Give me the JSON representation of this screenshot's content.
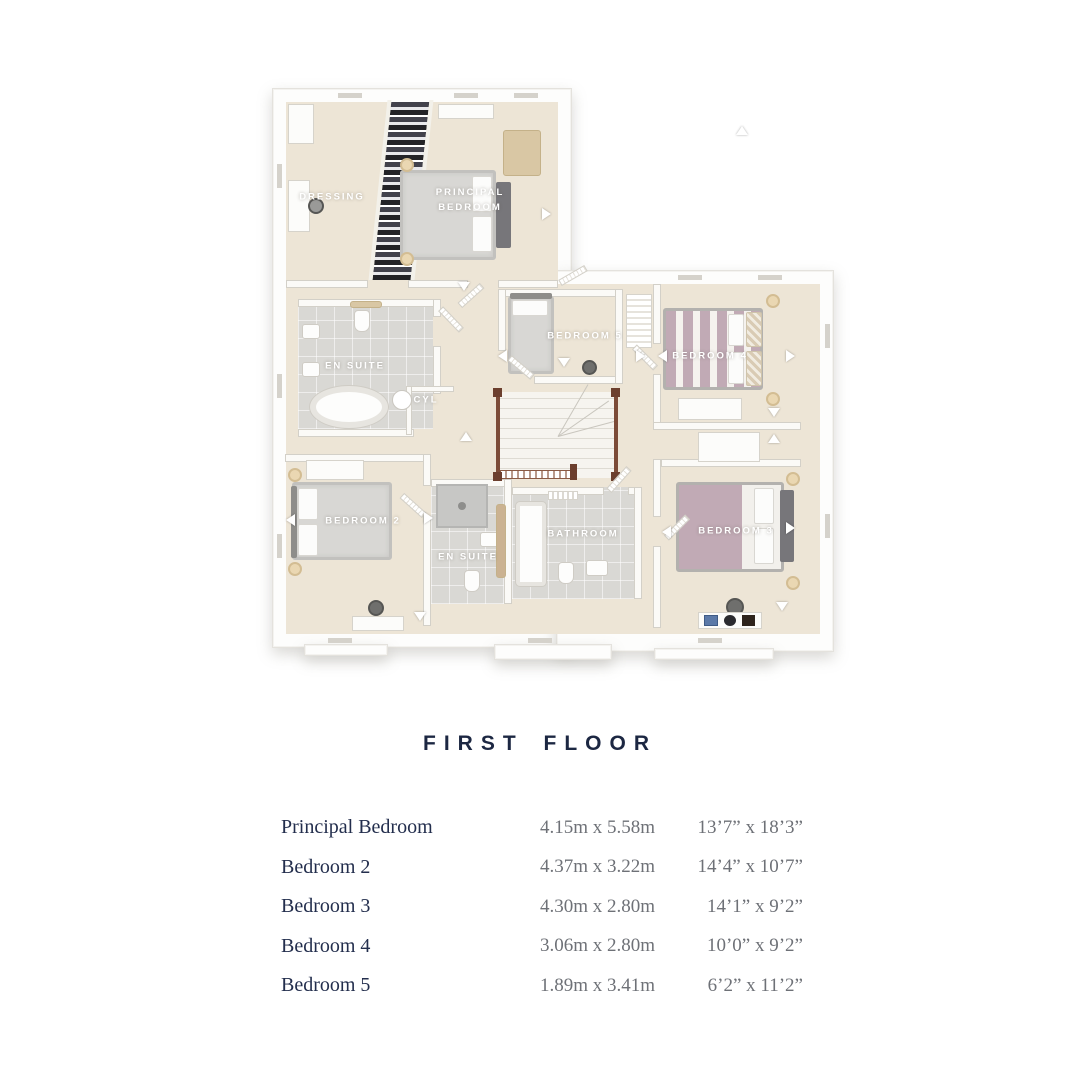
{
  "title": "FIRST FLOOR",
  "plan": {
    "rooms": [
      {
        "id": "dressing",
        "label": "DRESSING"
      },
      {
        "id": "principal-bedroom",
        "label": "PRINCIPAL BEDROOM"
      },
      {
        "id": "en-suite-1",
        "label": "EN SUITE"
      },
      {
        "id": "cyl",
        "label": "CYL"
      },
      {
        "id": "bedroom-5",
        "label": "BEDROOM 5"
      },
      {
        "id": "bedroom-4",
        "label": "BEDROOM 4"
      },
      {
        "id": "bedroom-2",
        "label": "BEDROOM 2"
      },
      {
        "id": "en-suite-2",
        "label": "EN SUITE"
      },
      {
        "id": "bathroom",
        "label": "BATHROOM"
      },
      {
        "id": "bedroom-3",
        "label": "BEDROOM 3"
      }
    ]
  },
  "dimensions_table": {
    "rows": [
      {
        "room": "Principal Bedroom",
        "metric": "4.15m x 5.58m",
        "imperial": "13’7” x 18’3”"
      },
      {
        "room": "Bedroom 2",
        "metric": "4.37m x 3.22m",
        "imperial": "14’4” x 10’7”"
      },
      {
        "room": "Bedroom 3",
        "metric": "4.30m x 2.80m",
        "imperial": "14’1” x 9’2”"
      },
      {
        "room": "Bedroom 4",
        "metric": "3.06m x 2.80m",
        "imperial": "10’0” x 9’2”"
      },
      {
        "room": "Bedroom 5",
        "metric": "1.89m x 3.41m",
        "imperial": "6’2” x 11’2”"
      }
    ]
  },
  "colors": {
    "title_navy": "#1c2742",
    "table_gray": "#6e7177",
    "floor_cream": "#ede5d6",
    "tile_gray": "#d9d8d4",
    "bed_mauve": "#c1aab5",
    "stair_wood": "#7c4b38",
    "lamp_tan": "#ead7b2"
  }
}
